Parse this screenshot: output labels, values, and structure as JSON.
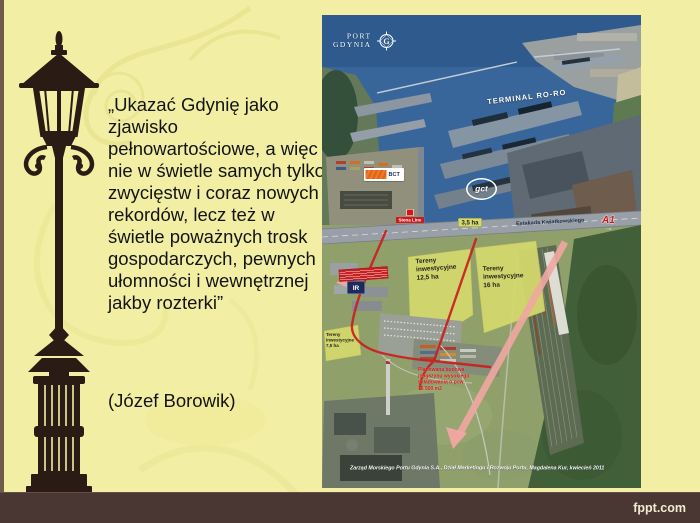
{
  "slide": {
    "quote_text": "„Ukazać Gdynię jako zjawisko pełnowartościowe, a więc nie w świetle samych tylko zwycięstw i coraz nowych rekordów, lecz też w świetle poważnych trosk gospodarczych, pewnych ułomności i wewnętrznej  jakby rozterki”",
    "attribution": "(Józef Borowik)",
    "watermark": "fppt.com"
  },
  "map": {
    "logo": {
      "name_line1": "Port",
      "name_line2": "Gdynia",
      "monogram": "G"
    },
    "labels": {
      "terminal_roro": "TERMINAL RO-RO",
      "bct": "BCT",
      "gct": "gct",
      "stena_line": "Stena Line",
      "plot_35ha": "3,5 ha",
      "estakada": "Estakada Kwiatkowskiego",
      "a1": "A1",
      "zone_125": "Tereny\ninwestycyjne\n12,5 ha",
      "zone_16": "Tereny\ninwestycyjne\n16 ha",
      "zone_75": "Tereny\ninwestycyjne\n7,5 ha",
      "ir_badge": "IR",
      "planned_warehouse": "Planowana budowa\nmagazynu wysokiego\nskładowania o pow.\n16 500 m2",
      "caption": "Zarząd Morskiego Portu Gdynia S.A., Dział Marketingu i Rozwoju Portu, Magdalena Kur, kwiecień 2011"
    },
    "colors": {
      "investment_zone": "#d5d96e",
      "planned_route_red": "#c92020",
      "flow_arrow_pink": "#f1a7a2",
      "water": "#39669a"
    }
  },
  "theme": {
    "background": "#f2efa4",
    "footer_bar": "#4a3733",
    "lamp_silhouette": "#2a1c15",
    "text": "#141414"
  }
}
